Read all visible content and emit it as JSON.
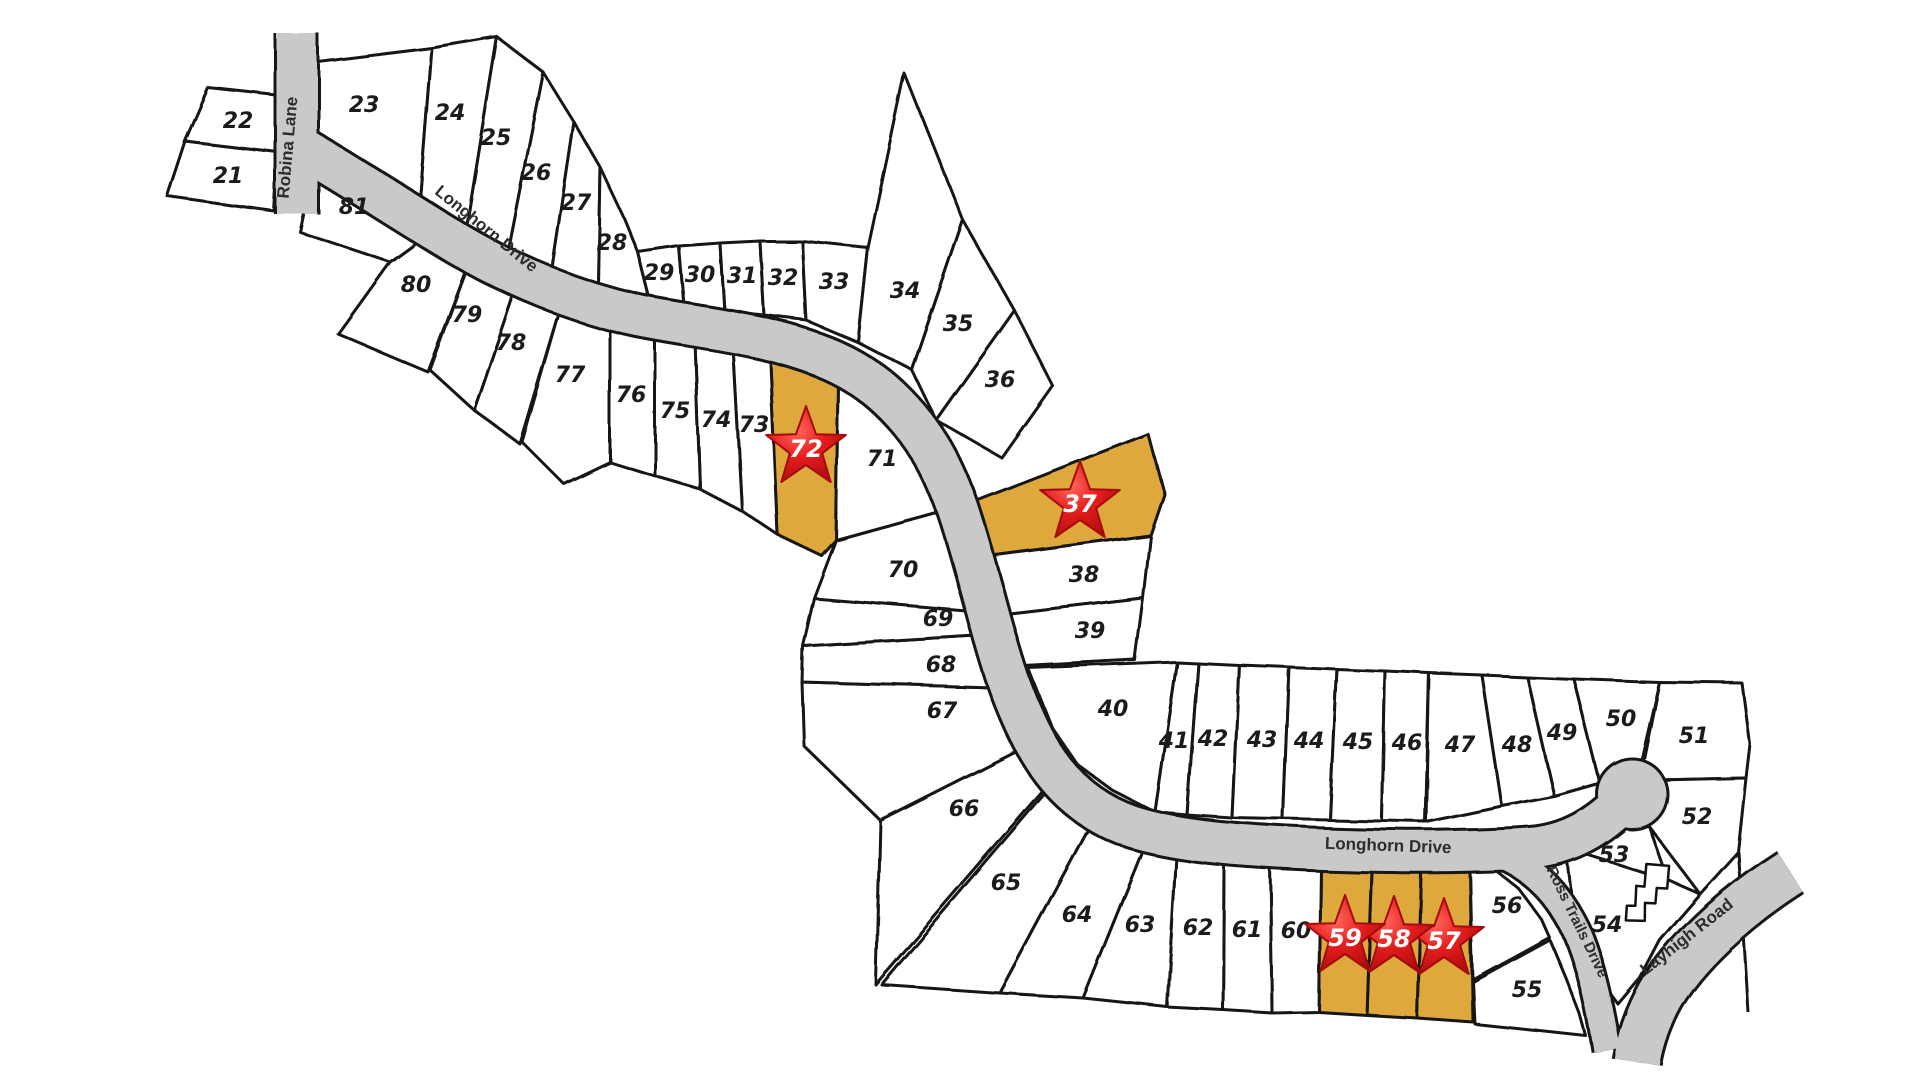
{
  "map": {
    "colors": {
      "background": "#ffffff",
      "lot_fill": "#ffffff",
      "lot_stroke": "#151515",
      "highlight_fill": "#dfa83c",
      "road_fill": "#c9c9c9",
      "road_casing": "#151515",
      "star_red_light": "#ff6a5e",
      "star_red": "#e51c1c",
      "star_red_dark": "#a50b0b",
      "star_text": "#ffffff",
      "label_color": "#1b1b1b"
    },
    "roads": [
      {
        "name": "robina-lane",
        "path": "M297,34 L297,214",
        "width": 40
      },
      {
        "name": "longhorn-drive",
        "path": "M302,148 C350,176 405,212 458,244 C512,276 575,302 640,316 C700,328 760,332 822,356 C868,374 902,404 930,448 C955,488 966,535 983,595 C998,650 1010,698 1038,748 C1060,786 1090,812 1130,826 C1175,841 1240,846 1310,849 C1390,852 1470,852 1530,848 C1570,845 1600,826 1625,800",
        "width": 40
      },
      {
        "name": "ross-trails-drive",
        "path": "M1500,854 C1534,868 1560,896 1577,932 C1590,962 1600,1006 1607,1050",
        "width": 26
      },
      {
        "name": "layhigh-road",
        "path": "M1790,872 C1734,908 1684,954 1660,996 C1648,1018 1640,1042 1637,1062",
        "width": 46
      }
    ],
    "culdesac": {
      "cx": 1632,
      "cy": 794,
      "r": 34
    },
    "boundary_extra": "M1738,852 L1748,1012",
    "road_labels": [
      {
        "text": "Robina Lane",
        "x": 293,
        "y": 148,
        "rotate": -85,
        "small": false
      },
      {
        "text": "Longhorn Drive",
        "x": 483,
        "y": 233,
        "rotate": 39,
        "small": false
      },
      {
        "text": "Longhorn Drive",
        "x": 1388,
        "y": 851,
        "rotate": 2,
        "small": false
      },
      {
        "text": "Ross Trails Drive",
        "x": 1573,
        "y": 924,
        "rotate": 64,
        "small": true
      },
      {
        "text": "Layhigh Road",
        "x": 1690,
        "y": 941,
        "rotate": -38,
        "small": false
      }
    ],
    "house_icon": {
      "x": 1646,
      "y": 900,
      "rotate": 20
    },
    "lots": [
      {
        "number": "21",
        "points": "185,141 278,152 274,211 167,196",
        "label": {
          "x": 228,
          "y": 183
        },
        "highlighted": false
      },
      {
        "number": "22",
        "points": "208,88 281,96 278,152 185,141",
        "label": {
          "x": 238,
          "y": 128
        },
        "highlighted": false
      },
      {
        "number": "23",
        "points": "318,62 432,48 420,201 318,152",
        "label": {
          "x": 364,
          "y": 112
        },
        "highlighted": false
      },
      {
        "number": "24",
        "points": "432,48 497,37 466,228 420,201",
        "label": {
          "x": 450,
          "y": 120
        },
        "highlighted": false
      },
      {
        "number": "25",
        "points": "497,37 543,72 508,250 466,228",
        "label": {
          "x": 496,
          "y": 145
        },
        "highlighted": false
      },
      {
        "number": "26",
        "points": "543,72 574,122 552,268 508,250",
        "label": {
          "x": 536,
          "y": 180
        },
        "highlighted": false
      },
      {
        "number": "27",
        "points": "574,122 600,167 598,287 552,268",
        "label": {
          "x": 576,
          "y": 210
        },
        "highlighted": false
      },
      {
        "number": "28",
        "points": "600,167 624,218 638,252 650,300 598,287",
        "label": {
          "x": 612,
          "y": 250
        },
        "highlighted": false
      },
      {
        "number": "29",
        "points": "638,252 679,246 684,306 650,300",
        "label": {
          "x": 659,
          "y": 280
        },
        "highlighted": false
      },
      {
        "number": "30",
        "points": "679,246 720,243 724,311 684,306",
        "label": {
          "x": 700,
          "y": 282
        },
        "highlighted": false
      },
      {
        "number": "31",
        "points": "720,243 760,241 764,315 724,311",
        "label": {
          "x": 742,
          "y": 283
        },
        "highlighted": false
      },
      {
        "number": "32",
        "points": "760,241 802,241 806,320 764,315",
        "label": {
          "x": 783,
          "y": 285
        },
        "highlighted": false
      },
      {
        "number": "33",
        "points": "802,241 868,248 858,342 806,320",
        "label": {
          "x": 834,
          "y": 289
        },
        "highlighted": false
      },
      {
        "number": "34",
        "points": "858,342 868,248 905,74 963,220 912,370",
        "label": {
          "x": 905,
          "y": 298
        },
        "highlighted": false
      },
      {
        "number": "35",
        "points": "912,370 963,220 1014,310 936,420",
        "label": {
          "x": 958,
          "y": 331
        },
        "highlighted": false
      },
      {
        "number": "36",
        "points": "936,420 1014,310 1053,386 1002,458",
        "label": {
          "x": 1000,
          "y": 387
        },
        "highlighted": false
      },
      {
        "number": "37",
        "points": "965,505 1148,434 1164,494 1150,535 988,556",
        "highlighted": true,
        "star": {
          "x": 1080,
          "y": 503
        }
      },
      {
        "number": "38",
        "points": "988,556 1150,535 1143,598 1006,614",
        "label": {
          "x": 1084,
          "y": 582
        },
        "highlighted": false
      },
      {
        "number": "39",
        "points": "1006,614 1143,598 1135,660 1024,666",
        "label": {
          "x": 1090,
          "y": 638
        },
        "highlighted": false
      },
      {
        "number": "40",
        "points": "1028,668 1177,662 1155,812 1112,790 1078,765 1052,728",
        "label": {
          "x": 1113,
          "y": 716
        },
        "highlighted": false
      },
      {
        "number": "41",
        "points": "1177,662 1198,663 1187,815 1155,812",
        "label": {
          "x": 1174,
          "y": 748
        },
        "highlighted": false
      },
      {
        "number": "42",
        "points": "1198,663 1239,665 1232,818 1187,815",
        "label": {
          "x": 1213,
          "y": 746
        },
        "highlighted": false
      },
      {
        "number": "43",
        "points": "1239,665 1289,667 1283,819 1232,818",
        "label": {
          "x": 1262,
          "y": 747
        },
        "highlighted": false
      },
      {
        "number": "44",
        "points": "1289,667 1337,669 1330,820 1283,819",
        "label": {
          "x": 1309,
          "y": 748
        },
        "highlighted": false
      },
      {
        "number": "45",
        "points": "1337,669 1385,671 1382,821 1330,820",
        "label": {
          "x": 1358,
          "y": 749
        },
        "highlighted": false
      },
      {
        "number": "46",
        "points": "1385,671 1429,673 1425,822 1382,821",
        "label": {
          "x": 1407,
          "y": 750
        },
        "highlighted": false
      },
      {
        "number": "47",
        "points": "1429,673 1482,675 1502,806 1426,822",
        "label": {
          "x": 1460,
          "y": 752
        },
        "highlighted": false
      },
      {
        "number": "48",
        "points": "1482,675 1527,677 1554,796 1502,806",
        "label": {
          "x": 1517,
          "y": 752
        },
        "highlighted": false
      },
      {
        "number": "49",
        "points": "1527,677 1574,679 1600,783 1554,796",
        "label": {
          "x": 1562,
          "y": 740
        },
        "highlighted": false
      },
      {
        "number": "50",
        "points": "1574,679 1659,682 1640,764 1600,783",
        "label": {
          "x": 1621,
          "y": 726
        },
        "highlighted": false
      },
      {
        "number": "51",
        "points": "1659,682 1742,683 1750,744 1746,778 1657,780 1642,766",
        "label": {
          "x": 1694,
          "y": 743
        },
        "highlighted": false
      },
      {
        "number": "52",
        "points": "1657,780 1746,778 1738,852 1700,894 1649,826 1660,800",
        "label": {
          "x": 1697,
          "y": 824
        },
        "highlighted": false
      },
      {
        "number": "53",
        "points": "1605,826 1649,826 1668,880 1566,848",
        "label": {
          "x": 1614,
          "y": 862
        },
        "highlighted": false
      },
      {
        "number": "54",
        "points": "1566,848 1668,880 1700,894 1660,940 1640,978 1618,1004 1590,966 1574,916",
        "label": {
          "x": 1607,
          "y": 932
        },
        "highlighted": false
      },
      {
        "number": "55",
        "points": "1473,982 1550,940 1566,978 1580,1014 1586,1036 1475,1024",
        "label": {
          "x": 1527,
          "y": 997
        },
        "highlighted": false
      },
      {
        "number": "56",
        "points": "1470,872 1495,870 1518,888 1542,920 1550,938 1473,980",
        "label": {
          "x": 1507,
          "y": 913
        },
        "highlighted": false
      },
      {
        "number": "57",
        "points": "1421,871 1470,872 1473,1022 1417,1018",
        "highlighted": true,
        "star": {
          "x": 1444,
          "y": 940
        }
      },
      {
        "number": "58",
        "points": "1372,870 1421,871 1417,1018 1367,1015",
        "highlighted": true,
        "star": {
          "x": 1394,
          "y": 938
        }
      },
      {
        "number": "59",
        "points": "1321,868 1372,870 1367,1015 1319,1012",
        "highlighted": true,
        "star": {
          "x": 1345,
          "y": 937
        }
      },
      {
        "number": "60",
        "points": "1270,866 1321,868 1319,1012 1272,1013",
        "label": {
          "x": 1296,
          "y": 938
        },
        "highlighted": false
      },
      {
        "number": "61",
        "points": "1224,862 1270,866 1272,1013 1223,1010",
        "label": {
          "x": 1247,
          "y": 937
        },
        "highlighted": false
      },
      {
        "number": "62",
        "points": "1176,855 1224,862 1223,1010 1167,1007",
        "label": {
          "x": 1198,
          "y": 935
        },
        "highlighted": false
      },
      {
        "number": "63",
        "points": "1146,842 1176,855 1167,1007 1083,998",
        "label": {
          "x": 1140,
          "y": 932
        },
        "highlighted": false
      },
      {
        "number": "64",
        "points": "1098,810 1146,842 1083,998 1000,993",
        "label": {
          "x": 1077,
          "y": 922
        },
        "highlighted": false
      },
      {
        "number": "65",
        "points": "1058,778 1098,810 1000,993 882,985",
        "label": {
          "x": 1006,
          "y": 890
        },
        "highlighted": false
      },
      {
        "number": "66",
        "points": "880,820 1030,744 1056,776 876,985",
        "label": {
          "x": 964,
          "y": 816
        },
        "highlighted": false
      },
      {
        "number": "67",
        "points": "802,682 1012,688 1030,744 880,820 804,746",
        "label": {
          "x": 942,
          "y": 718
        },
        "highlighted": false
      },
      {
        "number": "68",
        "points": "803,646 1000,634 1012,688 802,682",
        "label": {
          "x": 941,
          "y": 672
        },
        "highlighted": false
      },
      {
        "number": "69",
        "points": "814,598 980,610 1000,634 803,646",
        "label": {
          "x": 938,
          "y": 626
        },
        "highlighted": false
      },
      {
        "number": "70",
        "points": "836,540 945,510 962,560 978,612 814,598",
        "label": {
          "x": 903,
          "y": 577
        },
        "highlighted": false
      },
      {
        "number": "71",
        "points": "838,378 888,412 920,456 945,510 836,540",
        "label": {
          "x": 882,
          "y": 466
        },
        "highlighted": false
      },
      {
        "number": "72",
        "points": "770,352 838,378 836,540 822,556 778,535",
        "highlighted": true,
        "star": {
          "x": 806,
          "y": 448
        }
      },
      {
        "number": "73",
        "points": "733,346 770,352 778,535 742,511",
        "label": {
          "x": 754,
          "y": 432
        },
        "highlighted": false
      },
      {
        "number": "74",
        "points": "695,341 733,346 742,511 700,489",
        "label": {
          "x": 716,
          "y": 427
        },
        "highlighted": false
      },
      {
        "number": "75",
        "points": "655,336 695,341 700,489 655,476",
        "label": {
          "x": 675,
          "y": 418
        },
        "highlighted": false
      },
      {
        "number": "76",
        "points": "610,328 655,336 655,476 610,462",
        "label": {
          "x": 631,
          "y": 402
        },
        "highlighted": false
      },
      {
        "number": "77",
        "points": "560,310 610,328 610,462 564,484 522,442",
        "label": {
          "x": 570,
          "y": 382
        },
        "highlighted": false
      },
      {
        "number": "78",
        "points": "514,292 560,310 520,444 474,410",
        "label": {
          "x": 511,
          "y": 350
        },
        "highlighted": false
      },
      {
        "number": "79",
        "points": "468,266 514,292 474,410 430,370",
        "label": {
          "x": 467,
          "y": 322
        },
        "highlighted": false
      },
      {
        "number": "80",
        "points": "390,262 420,240 468,266 428,372 338,334",
        "label": {
          "x": 416,
          "y": 292
        },
        "highlighted": false
      },
      {
        "number": "81",
        "points": "313,170 368,208 420,240 390,262 300,232",
        "label": {
          "x": 354,
          "y": 214
        },
        "highlighted": false
      }
    ]
  }
}
